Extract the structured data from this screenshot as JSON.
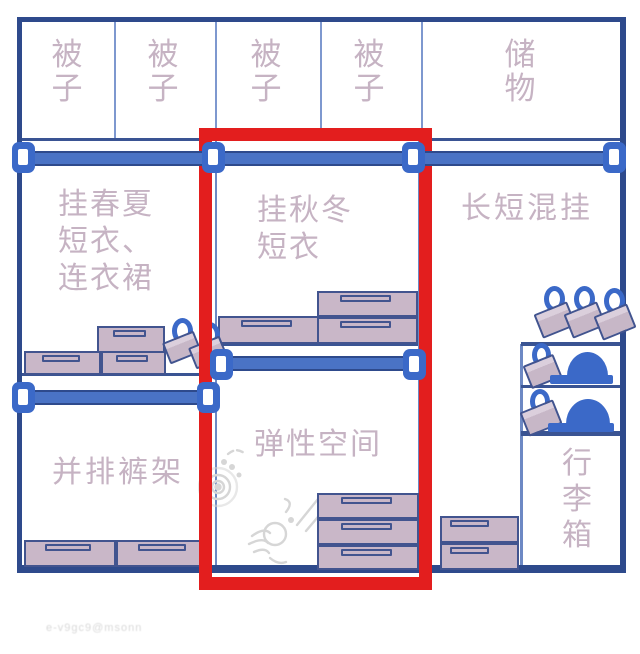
{
  "title": "wardrobe-organization-diagram",
  "colors": {
    "frame_navy": "#2e4a8c",
    "rod_blue": "#4a73c5",
    "bracket_blue": "#3b69c8",
    "box_mauve": "#c9b7c8",
    "label_mauve": "#c6b3c3",
    "highlight_red": "#e31e1e",
    "doodle_gray": "#d6d6d6"
  },
  "top_row": {
    "items": [
      {
        "name": "quilt-1",
        "label": "被子",
        "lines": [
          "被",
          "子"
        ]
      },
      {
        "name": "quilt-2",
        "label": "被子",
        "lines": [
          "被",
          "子"
        ]
      },
      {
        "name": "quilt-3",
        "label": "被子",
        "lines": [
          "被",
          "子"
        ]
      },
      {
        "name": "quilt-4",
        "label": "被子",
        "lines": [
          "被",
          "子"
        ]
      },
      {
        "name": "storage",
        "label": "储物",
        "lines": [
          "储",
          "物"
        ]
      }
    ]
  },
  "sections": {
    "spring_summer": {
      "label": "挂春夏短衣、连衣裙",
      "lines": [
        "挂春夏",
        "短衣、",
        "连衣裙"
      ]
    },
    "autumn_winter": {
      "label": "挂秋冬短衣",
      "lines": [
        "挂秋冬",
        "短衣"
      ]
    },
    "mixed_hang": {
      "label": "长短混挂"
    },
    "pants_rack": {
      "label": "并排裤架"
    },
    "flex_space": {
      "label": "弹性空间"
    },
    "luggage": {
      "label": "行李箱",
      "lines": [
        "行",
        "李",
        "箱"
      ]
    }
  },
  "watermark": "e-v9gc9@msonn"
}
